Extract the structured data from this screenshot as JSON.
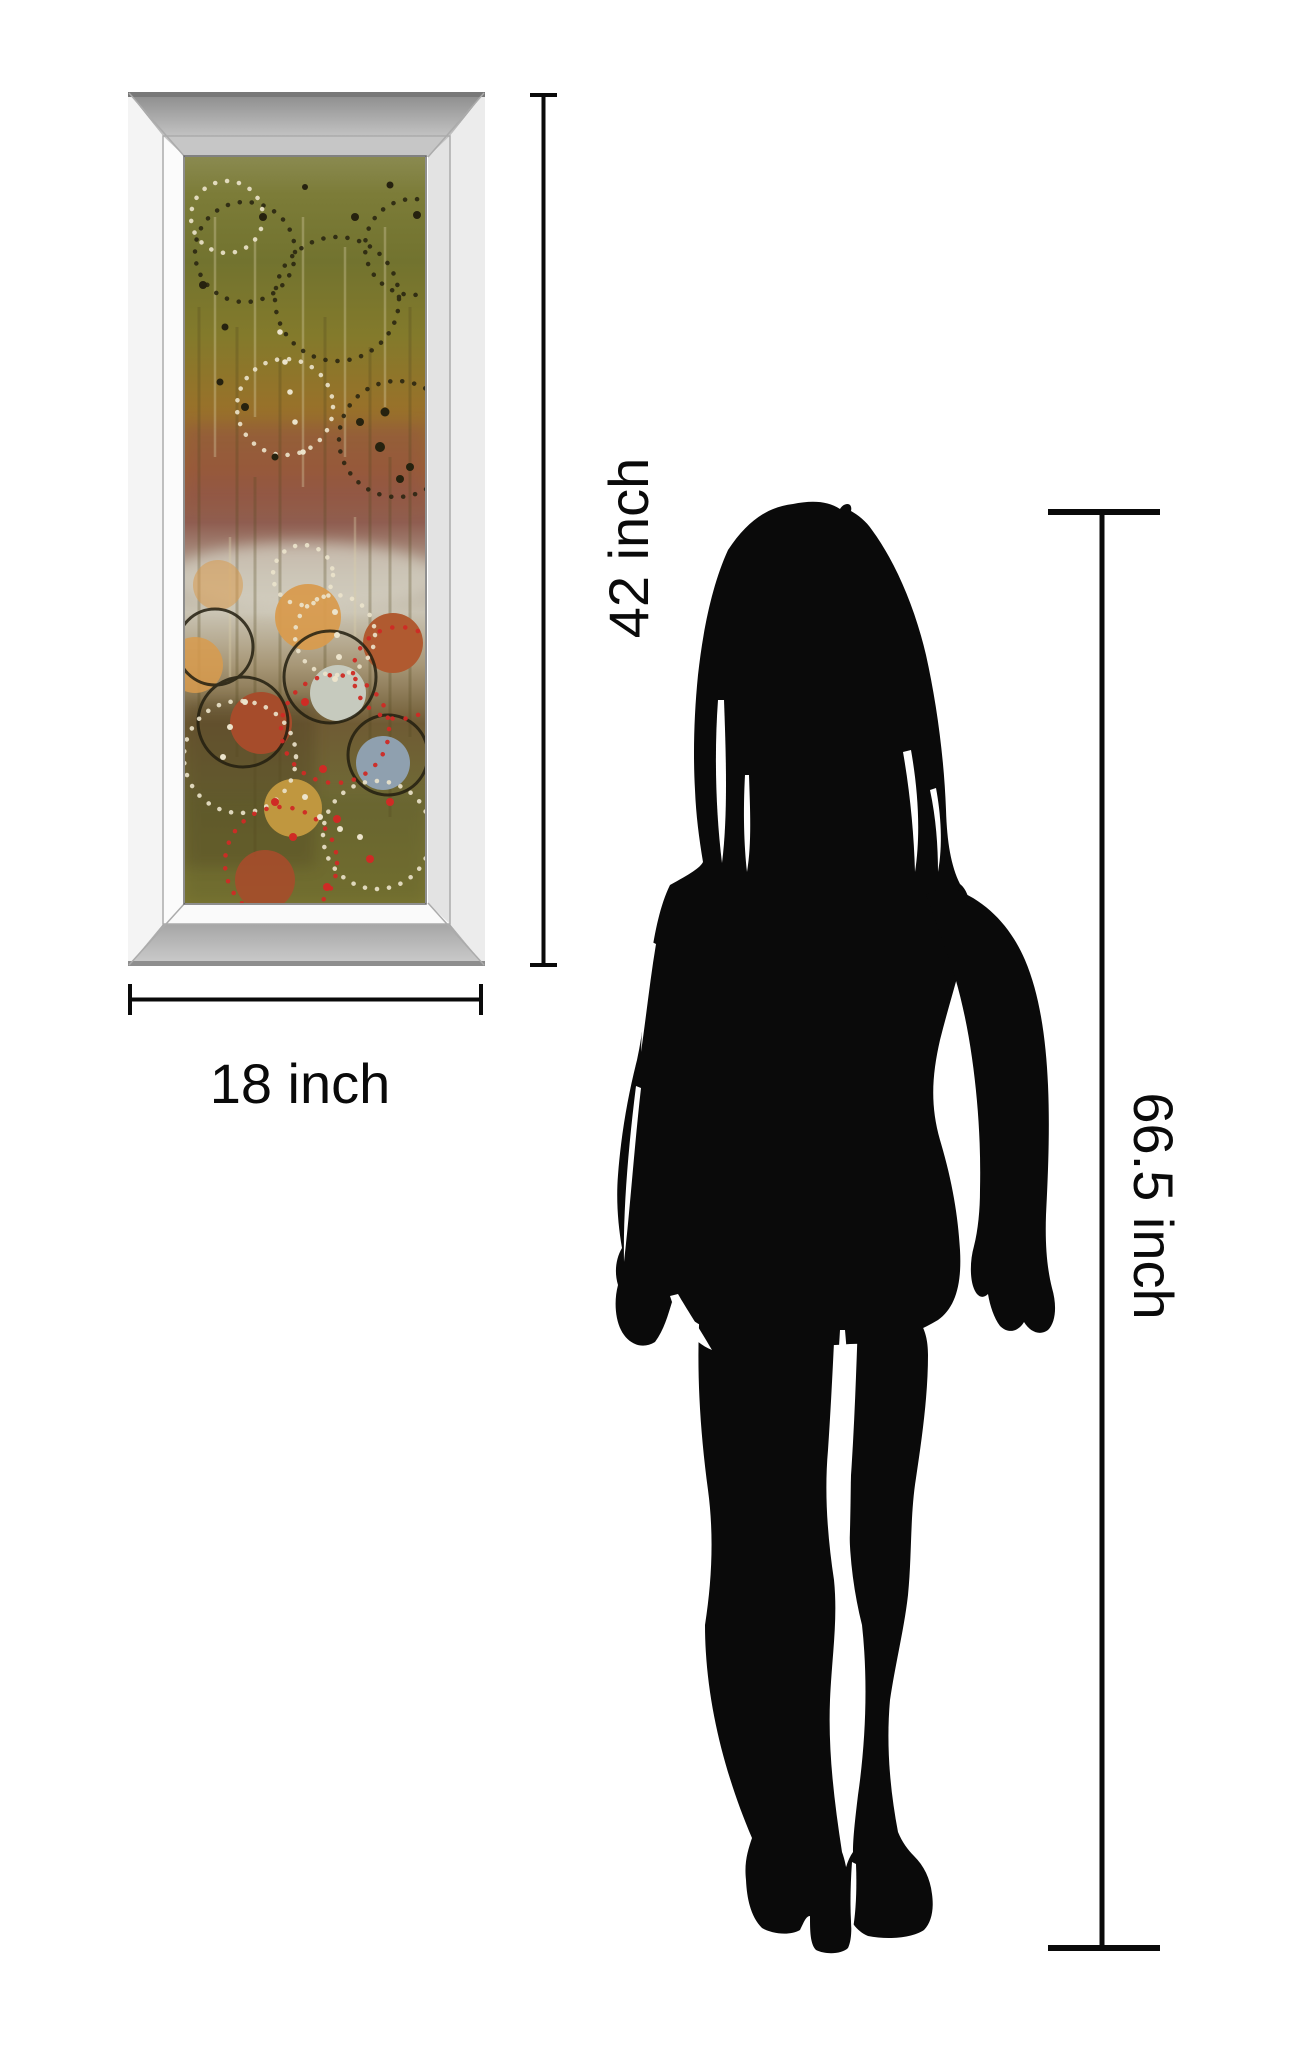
{
  "labels": {
    "art_height": "42 inch",
    "art_width": "18 inch",
    "person_height": "66.5 inch"
  },
  "measurements": {
    "artwork_height_inches": 42,
    "artwork_width_inches": 18,
    "person_height_inches": 66.5,
    "unit": "inch"
  },
  "colors": {
    "background": "#ffffff",
    "ink": "#0a0a0a",
    "frame": {
      "face_left": "#f4f4f4",
      "face_right": "#ececec",
      "bevel_left": "#fbfbfb",
      "bevel_right": "#e3e3e3",
      "bevel_bottom": "#fafafa",
      "bevel_top_inner": "#c6c6c6",
      "top_band_outer": "#8a8a8a",
      "top_band_inner": "#c2c2c2",
      "bottom_band_inner": "#a6a6a6",
      "bottom_band_outer": "#cdcdcd",
      "top_lip": "#787878",
      "bottom_lip": "#8e8e8e",
      "miter_line": "#ababab",
      "inner_line": "#6a6a6a"
    },
    "art": {
      "grad": [
        "#8a8a50",
        "#7c7c38",
        "#72732f",
        "#837a2b",
        "#97722a",
        "#9d6133",
        "#8f5d50",
        "#b5a898",
        "#cac4b4",
        "#a89878",
        "#6f5b34",
        "#6f6a35",
        "#7b7733"
      ],
      "circle_orange": "#d89b4e",
      "circle_rust": "#a64c2b",
      "circle_rust2": "#b05a30",
      "circle_pale": "#c6cabe",
      "circle_blue": "#8fa0af",
      "circle_tan": "#c0973f",
      "ring_black": "#231f10",
      "dot_white": "#ece4cc",
      "dot_black": "#26220f",
      "dot_red": "#cf2b25",
      "streak_dark": "#54491f",
      "streak_light": "#d9cfa8",
      "mauve_band": "#8a4a4e",
      "silver_band": "#d6d2c4",
      "shadow_brown": "#4f3f22",
      "olive_smudge": "#5c5a28"
    }
  }
}
